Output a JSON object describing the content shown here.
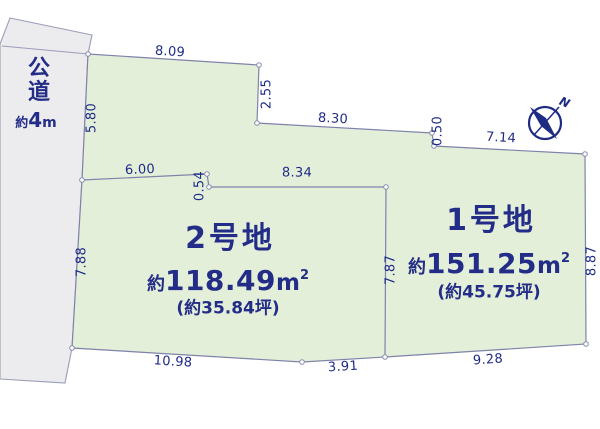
{
  "diagram_type": "land-plot-layout",
  "road": {
    "name": [
      "公",
      "道"
    ],
    "width": {
      "prefix": "約",
      "value": "4",
      "unit": "m"
    }
  },
  "plots": {
    "no2": {
      "name": "2号地",
      "area": {
        "prefix": "約",
        "value": "118.49",
        "unit": "m",
        "sup": "2"
      },
      "tsubo": "(約35.84坪)"
    },
    "no1": {
      "name": "1号地",
      "area": {
        "prefix": "約",
        "value": "151.25",
        "unit": "m",
        "sup": "2"
      },
      "tsubo": "(約45.75坪)"
    }
  },
  "dimensions": [
    {
      "edge": "north-upper",
      "label": "8.09"
    },
    {
      "edge": "north-step",
      "label": "2.55"
    },
    {
      "edge": "north-mid",
      "label": "8.30"
    },
    {
      "edge": "north-step-2",
      "label": "0.50"
    },
    {
      "edge": "north-right",
      "label": "7.14"
    },
    {
      "edge": "road-frontage-upper",
      "label": "5.80"
    },
    {
      "edge": "divider-west",
      "label": "6.00"
    },
    {
      "edge": "divider-step",
      "label": "0.54"
    },
    {
      "edge": "divider-north",
      "label": "8.34"
    },
    {
      "edge": "road-frontage-plot2",
      "label": "7.88"
    },
    {
      "edge": "divider-east",
      "label": "7.87"
    },
    {
      "edge": "east-side",
      "label": "8.87"
    },
    {
      "edge": "south-plot2",
      "label": "10.98"
    },
    {
      "edge": "south-middle",
      "label": "3.91"
    },
    {
      "edge": "south-plot1",
      "label": "9.28"
    }
  ],
  "compass": {
    "north_label": "N"
  },
  "colors": {
    "parcel_fill": "#e4efda",
    "road_fill": "#ececee",
    "boundary_line": "#7f83aa",
    "label_text": "#232d87"
  }
}
